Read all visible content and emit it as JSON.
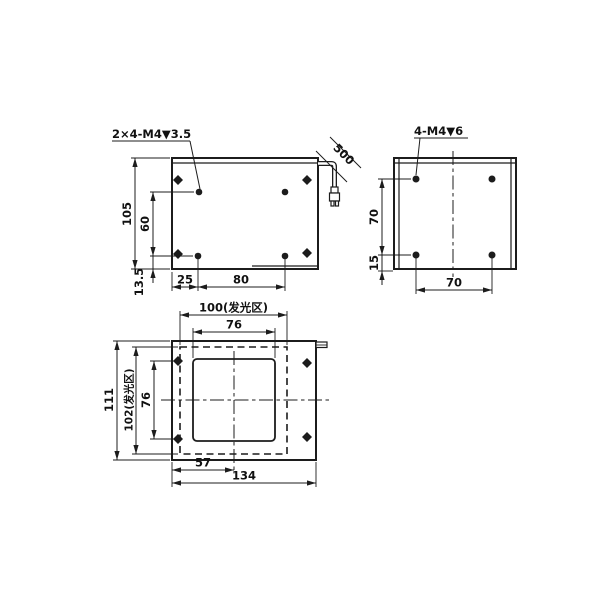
{
  "drawing_colors": {
    "line": "#1c1c1c",
    "background": "#ffffff"
  },
  "views": {
    "top_view": {
      "thread_callout": "2×4-M4▼3.5",
      "cable_length": "500",
      "overall_height": "105",
      "hole_spacing_vertical": "60",
      "edge_offset": "13.5",
      "hole_offset_left": "25",
      "hole_spacing_horizontal": "80"
    },
    "side_view": {
      "thread_callout": "4-M4▼6",
      "hole_spacing_vertical": "70",
      "edge_offset": "15",
      "hole_spacing_horizontal": "70"
    },
    "front_view": {
      "emitting_area_width": "100(发光区)",
      "window_width": "76",
      "overall_height": "111",
      "emitting_area_height": "102(发光区)",
      "hole_spacing_vertical": "76",
      "center_offset": "57",
      "overall_width": "134"
    }
  }
}
